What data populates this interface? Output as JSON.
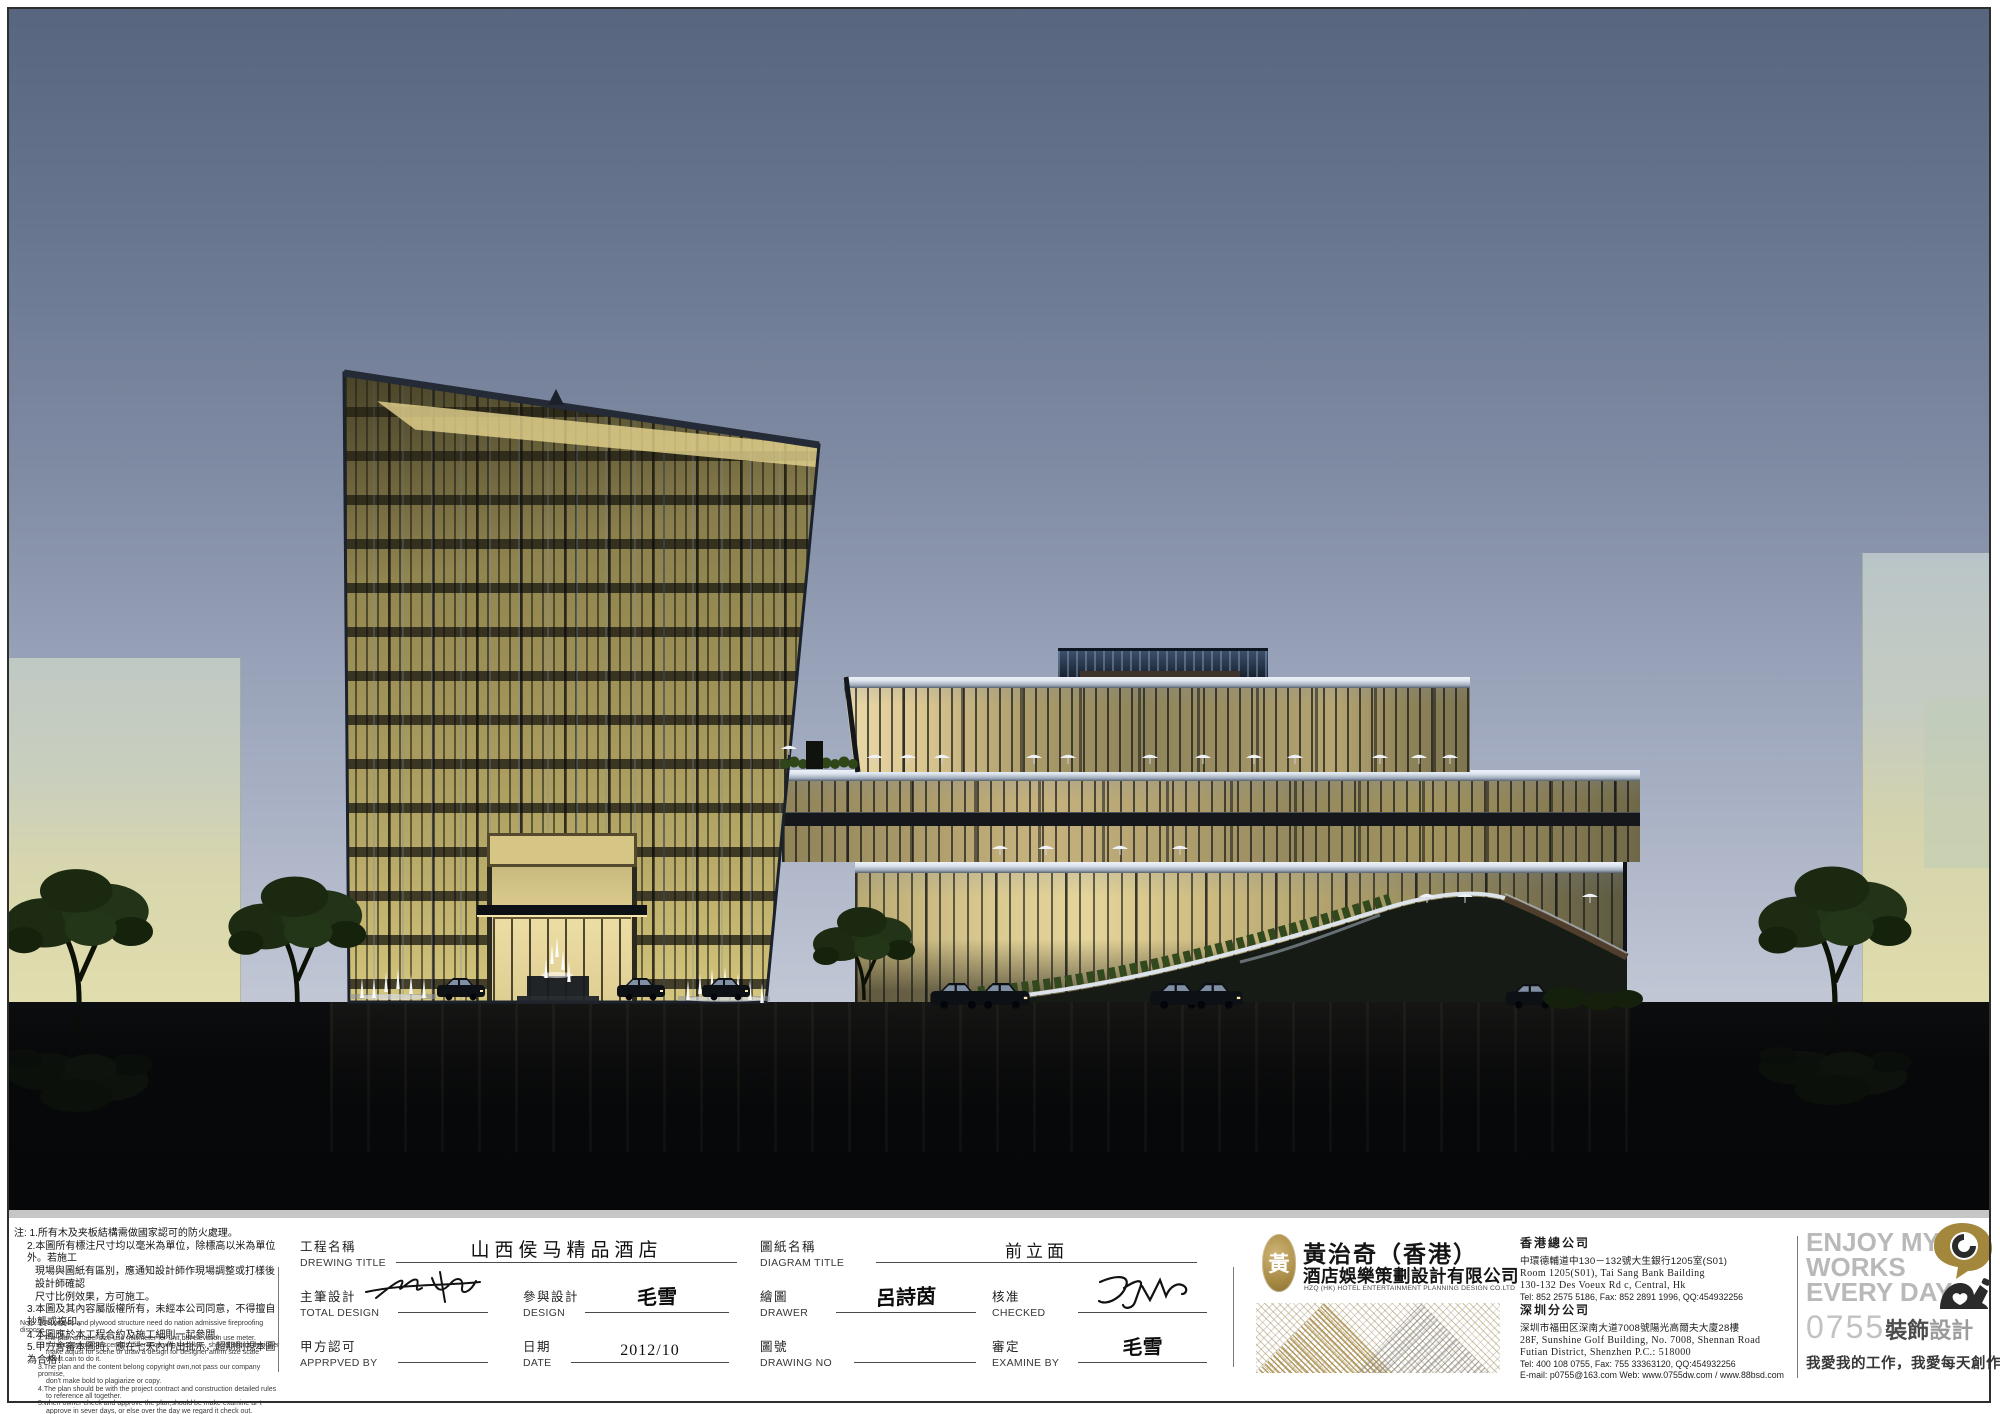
{
  "colors": {
    "sky-top": "#57667e",
    "sky-bottom": "#ccd1dc",
    "glass-olive": "#9a8d58",
    "glass-bright": "#e3d49c",
    "coping": "#dce4ee",
    "bg-building": "#e0ddab",
    "ground": "#060708",
    "tree": "#1e2d14",
    "gold": "#a98c45",
    "gray-brand": "#b9b9b9",
    "ink": "#2e2e2e"
  },
  "notes": {
    "cn": [
      "注: 1.所有木及夹板結構需做國家認可的防火處理。",
      "2.本圖所有標注尺寸均以毫米為單位，除標高以米為單位外。若施工",
      "現場與圖紙有區別，應通知設計師作現場調整或打樣後設計師確認",
      "尺寸比例效果，方可施工。",
      "3.本圖及其內容屬版權所有，未經本公司同意，不得擅自抄襲或複印。",
      "4.本圖應於本工程合約及施工細則一起參閱。",
      "5.甲方會審本圖時，應在七天內作出批示，超期則視本圖為合格！"
    ],
    "en": [
      "Note: 1.All woods and plywood structure need do nation admissive fireproofing dispose.",
      "2.The plan all label size use millimeter for unit,but elevation use meter.",
      "If the construction scene is difference with the plan , should inform designer",
      "make adjust for scene or  draw a design for designer affirm size scale",
      "effect.can to do it.",
      "3.The plan and the content belong copyright own,not pass our company promise,",
      "don't make bold  to  plagiarize or copy.",
      "4.The plan should be with the project contract and construction detailed rules",
      "to reference all together.",
      "5.when owner check and approve the plan,should be make examine ar-t",
      "approve in sever days, or else  over the day we regard it check out."
    ]
  },
  "fields": {
    "project": {
      "cn": "工程名稱",
      "en": "DREWING TITLE",
      "value": "山西侯马精品酒店"
    },
    "total_design": {
      "cn": "主筆設計",
      "en": "TOTAL DESIGN",
      "value": ""
    },
    "design": {
      "cn": "參與設計",
      "en": "DESIGN",
      "value": "毛雪"
    },
    "approved": {
      "cn": "甲方認可",
      "en": "APPRPVED BY",
      "value": ""
    },
    "date": {
      "cn": "日期",
      "en": "DATE",
      "value": "2012/10"
    },
    "diagram": {
      "cn": "圖紙名稱",
      "en": "DIAGRAM TITLE",
      "value": "前立面"
    },
    "drawer": {
      "cn": "繪圖",
      "en": "DRAWER",
      "value": "呂詩茵"
    },
    "checked": {
      "cn": "核准",
      "en": "CHECKED",
      "value": ""
    },
    "drawing_no": {
      "cn": "圖號",
      "en": "DRAWING NO",
      "value": ""
    },
    "examine": {
      "cn": "審定",
      "en": "EXAMINE BY",
      "value": "毛雪"
    }
  },
  "company": {
    "seal_char": "黃",
    "name_cn": "黃治奇（香港）",
    "name_cn2": "酒店娛樂策劃設計有限公司",
    "name_en": "HZQ (HK) HOTEL ENTERTAINMENT PLANNING DESIGN CO.LTD"
  },
  "office_hk": {
    "title": "香港總公司",
    "addr_cn": "中環德輔道中130－132號大生銀行1205室(S01)",
    "addr_en1": "Room 1205(S01), Tai Sang Bank Bailding",
    "addr_en2": "130-132 Des Voeux Rd c, Central, Hk",
    "tel": "Tel: 852 2575 5186, Fax: 852 2891 1996, QQ:454932256"
  },
  "office_sz": {
    "title": "深圳分公司",
    "addr_cn": "深圳市福田区深南大道7008號陽光高爾夫大廈28樓",
    "addr_en1": "28F, Sunshine Golf Building, No. 7008, Shennan Road",
    "addr_en2": "Futian District, Shenzhen   P.C.: 518000",
    "tel": "Tel: 400 108 0755,  Fax: 755 33363120, QQ:454932256",
    "email": "E-mail: p0755@163.com   Web: www.0755dw.com / www.88bsd.com"
  },
  "branding": {
    "l1": "ENJOY MY",
    "l2": "WORKS",
    "l3": "EVERY DAY",
    "code": "0755",
    "deco": "裝飾",
    "design": "設計",
    "slogan": "我愛我的工作，我愛每天創作"
  }
}
